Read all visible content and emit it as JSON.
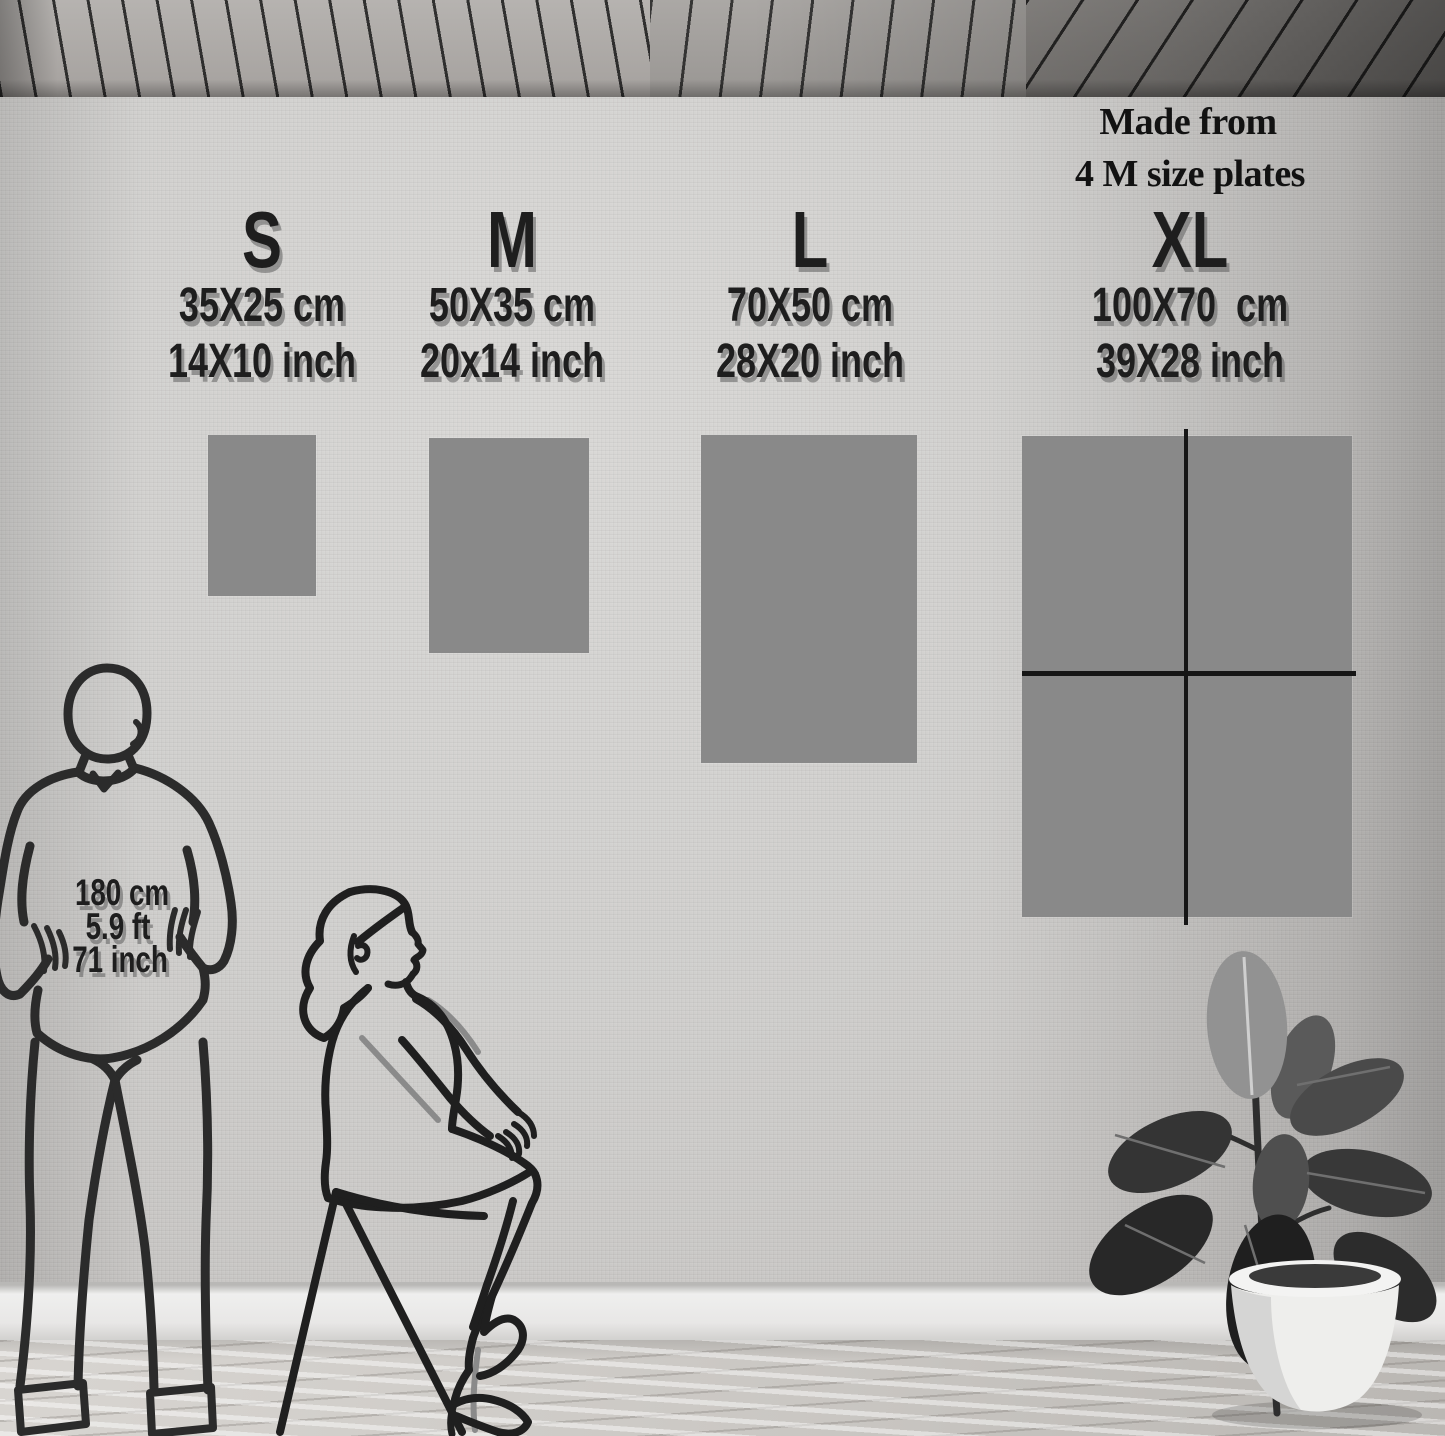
{
  "title": "Wall art size guide",
  "xl_note": {
    "line1": "Made from",
    "line2": "4 M size plates"
  },
  "sizes": [
    {
      "label": "S",
      "cm": "35X25 cm",
      "inch": "14X10 inch"
    },
    {
      "label": "M",
      "cm": "50X35 cm",
      "inch": "20x14 inch"
    },
    {
      "label": "L",
      "cm": "70X50 cm",
      "inch": "28X20 inch"
    },
    {
      "label": "XL",
      "cm": "100X70  cm",
      "inch": "39X28 inch"
    }
  ],
  "person_reference": {
    "cm": "180 cm",
    "ft": "5.9 ft",
    "inch": "71 inch"
  },
  "figures": {
    "man": "standing-man-line-art",
    "woman": "sitting-woman-line-art",
    "plant": "potted-rubber-plant"
  },
  "colors": {
    "swatch_gray": "#898989",
    "text": "#1e1e1e",
    "line_art": "#2b2b2b",
    "wall": "#d0cfcd",
    "baseboard": "#e8e7e6",
    "floor_wood": "#cac7c3",
    "ceiling_wood": "#a5a19e",
    "divider_line": "#161616"
  }
}
